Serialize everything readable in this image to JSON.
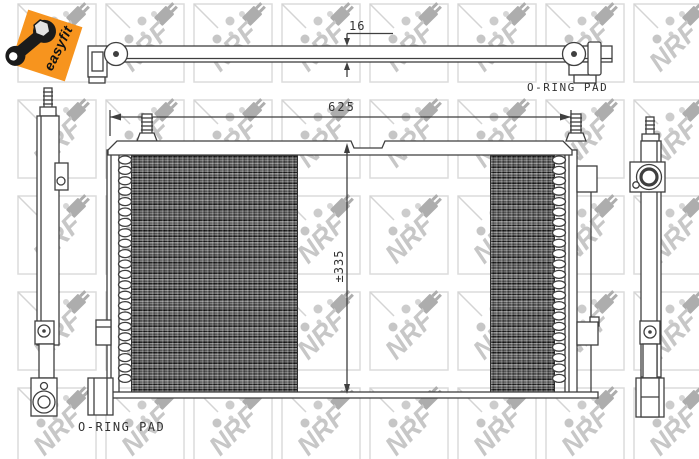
{
  "branding": {
    "easyfit_label": "easyfit",
    "easyfit_color": "#f7941e",
    "watermark_label": "NRF"
  },
  "dimensions": {
    "overall_width": "625",
    "overall_height": "±335",
    "depth": "16"
  },
  "annotations": {
    "oring_pad_top": "O-RING PAD",
    "oring_pad_bottom": "O-RING PAD"
  },
  "colors": {
    "line": "#3f3f3f",
    "watermark_gray": "#c7c7c7"
  }
}
